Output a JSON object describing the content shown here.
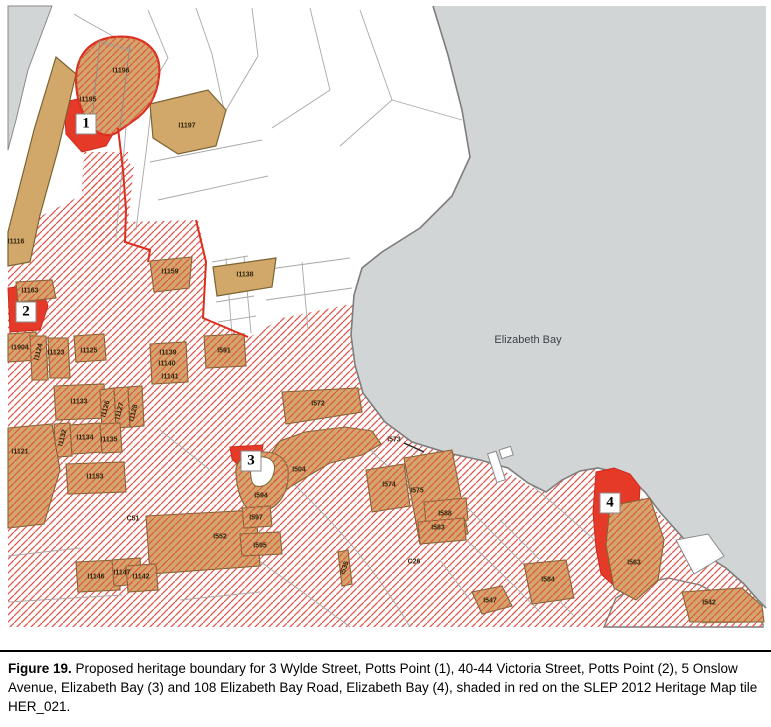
{
  "figure": {
    "caption_label": "Figure 19.",
    "caption_text": " Proposed heritage boundary for 3 Wylde Street, Potts Point (1), 40-44 Victoria Street, Potts Point (2), 5 Onslow Avenue, Elizabeth Bay (3) and 108 Elizabeth Bay Road, Elizabeth Bay (4), shaded in red on the SLEP 2012 Heritage Map tile HER_021."
  },
  "map": {
    "water_label": "Elizabeth Bay",
    "street_label": "Wylde Street",
    "colors": {
      "water": "#d2d5d6",
      "land": "#ffffff",
      "heritage_item_fill": "#d2a86a",
      "heritage_item_outline": "#7a6434",
      "hatch_red": "#e0564b",
      "proposed_boundary_red": "#e63a28",
      "parcel_line_gray": "#a8a8a8",
      "shoreline_gray": "#7d7d7d"
    },
    "markers": [
      {
        "label": "1",
        "x": 86,
        "y": 124
      },
      {
        "label": "2",
        "x": 26,
        "y": 312
      },
      {
        "label": "3",
        "x": 251,
        "y": 461
      },
      {
        "label": "4",
        "x": 610,
        "y": 503
      }
    ],
    "parcel_labels": [
      {
        "text": "I1196",
        "x": 121,
        "y": 71
      },
      {
        "text": "I1195",
        "x": 88,
        "y": 100
      },
      {
        "text": "I1197",
        "x": 187,
        "y": 126
      },
      {
        "text": "I1116",
        "x": 16,
        "y": 242
      },
      {
        "text": "I1163",
        "x": 30,
        "y": 291
      },
      {
        "text": "I1159",
        "x": 170,
        "y": 272
      },
      {
        "text": "I1138",
        "x": 245,
        "y": 275
      },
      {
        "text": "I1904",
        "x": 20,
        "y": 348
      },
      {
        "text": "I1124",
        "x": 39,
        "y": 352,
        "rot": -75
      },
      {
        "text": "I1123",
        "x": 56,
        "y": 353
      },
      {
        "text": "I1125",
        "x": 89,
        "y": 351
      },
      {
        "text": "I1139",
        "x": 168,
        "y": 353
      },
      {
        "text": "I1140",
        "x": 167,
        "y": 364
      },
      {
        "text": "I1141",
        "x": 170,
        "y": 377
      },
      {
        "text": "I591",
        "x": 224,
        "y": 351
      },
      {
        "text": "I1133",
        "x": 79,
        "y": 402
      },
      {
        "text": "I1126",
        "x": 106,
        "y": 409,
        "rot": -75
      },
      {
        "text": "I1127",
        "x": 120,
        "y": 411,
        "rot": -75
      },
      {
        "text": "I1128",
        "x": 134,
        "y": 413,
        "rot": -75
      },
      {
        "text": "I1132",
        "x": 63,
        "y": 438,
        "rot": -75
      },
      {
        "text": "I1134",
        "x": 85,
        "y": 438
      },
      {
        "text": "I1135",
        "x": 109,
        "y": 440
      },
      {
        "text": "I1153",
        "x": 95,
        "y": 477
      },
      {
        "text": "I1121",
        "x": 20,
        "y": 452
      },
      {
        "text": "C51",
        "x": 133,
        "y": 519
      },
      {
        "text": "I552",
        "x": 220,
        "y": 537
      },
      {
        "text": "I1146",
        "x": 96,
        "y": 577
      },
      {
        "text": "I1147",
        "x": 122,
        "y": 573
      },
      {
        "text": "I1142",
        "x": 141,
        "y": 577
      },
      {
        "text": "I572",
        "x": 318,
        "y": 404
      },
      {
        "text": "I573",
        "x": 394,
        "y": 440
      },
      {
        "text": "I504",
        "x": 299,
        "y": 470
      },
      {
        "text": "I594",
        "x": 261,
        "y": 496
      },
      {
        "text": "I597",
        "x": 256,
        "y": 518
      },
      {
        "text": "I595",
        "x": 260,
        "y": 546
      },
      {
        "text": "I535",
        "x": 345,
        "y": 568,
        "rot": -70
      },
      {
        "text": "C26",
        "x": 414,
        "y": 562
      },
      {
        "text": "I547",
        "x": 490,
        "y": 601
      },
      {
        "text": "I584",
        "x": 548,
        "y": 580
      },
      {
        "text": "I574",
        "x": 389,
        "y": 485
      },
      {
        "text": "I575",
        "x": 417,
        "y": 491
      },
      {
        "text": "I588",
        "x": 445,
        "y": 514
      },
      {
        "text": "I583",
        "x": 438,
        "y": 528
      },
      {
        "text": "I563",
        "x": 634,
        "y": 563
      },
      {
        "text": "I542",
        "x": 709,
        "y": 603
      }
    ]
  }
}
